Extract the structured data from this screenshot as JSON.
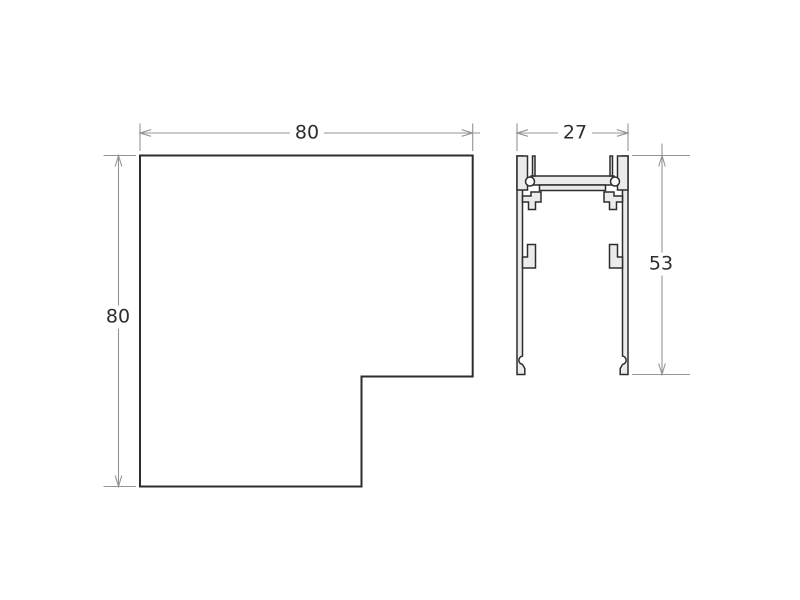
{
  "drawing": {
    "plan_view": {
      "description": "L-shaped corner connector plan",
      "width_label": "80",
      "height_label": "80"
    },
    "section_view": {
      "description": "Track extrusion cross-section",
      "width_label": "27",
      "height_label": "53"
    }
  },
  "colors": {
    "background": "#ffffff",
    "outline": "#2d2d2d",
    "metal_fill": "#ebebeb",
    "dimension_lines": "#949494",
    "label_text": "#2e2e2e"
  }
}
